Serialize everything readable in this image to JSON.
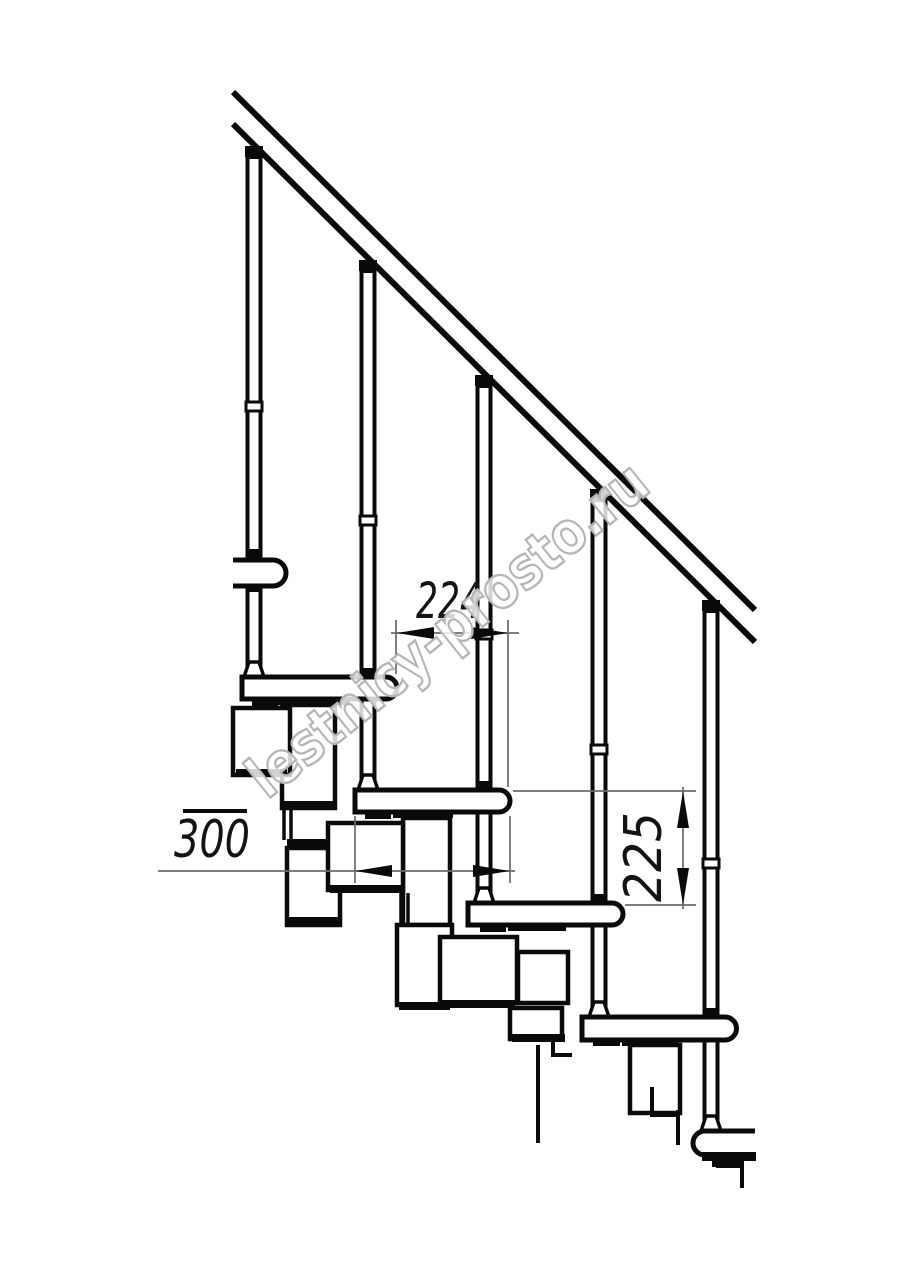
{
  "drawing": {
    "background": "#ffffff",
    "line_color": "#0a0a0a",
    "dimension_line_color": "#6b6b6b",
    "dimension_text_color": "#141414"
  },
  "dimensions": {
    "step_run_label": "224",
    "tread_depth_label": "300",
    "step_rise_label": "225"
  },
  "watermark": {
    "text": "lestnicy-prosto.ru",
    "color": "#b5b5b5"
  }
}
